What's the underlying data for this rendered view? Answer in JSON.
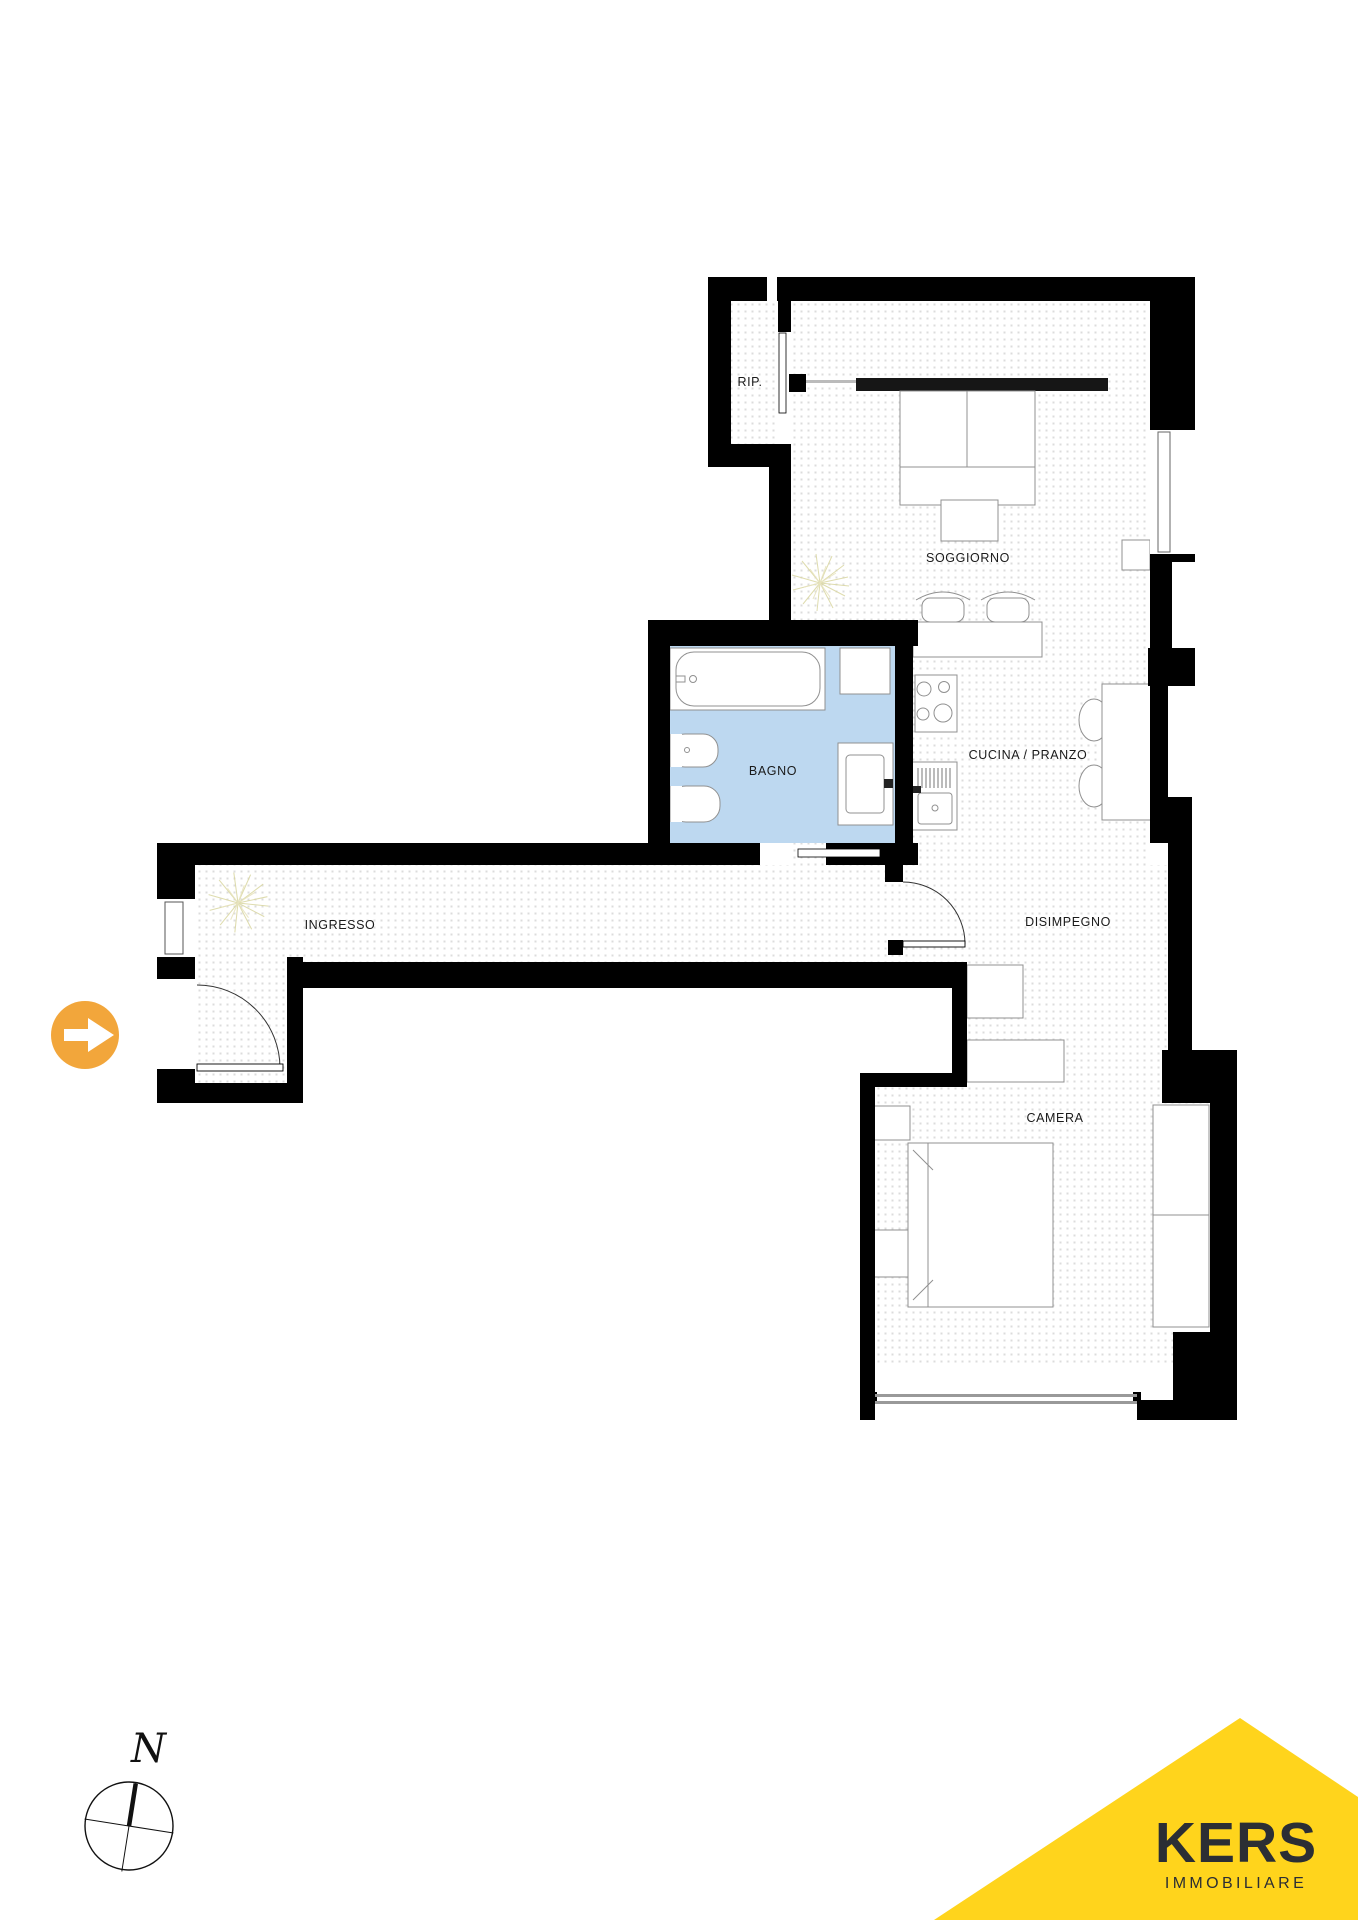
{
  "plan": {
    "labels": {
      "rip": "RIP.",
      "soggiorno": "SOGGIORNO",
      "bagno": "BAGNO",
      "cucina": "CUCINA / PRANZO",
      "ingresso": "INGRESSO",
      "disimpegno": "DISIMPEGNO",
      "camera": "CAMERA"
    },
    "compass": {
      "north": "N"
    },
    "entrance": {
      "marker": "arrow-right-icon"
    }
  },
  "branding": {
    "name": "KERS",
    "tagline": "IMMOBILIARE"
  },
  "colors": {
    "wall": "#000000",
    "bathroom_floor": "#bdd8f0",
    "floor_dot": "#dcdcdc",
    "furniture_line": "#909090",
    "brand_yellow": "#ffd41c",
    "entry_arrow_orange": "#f2a63b",
    "label_text": "#1a1a1a",
    "logo_text": "#2b2e34"
  }
}
